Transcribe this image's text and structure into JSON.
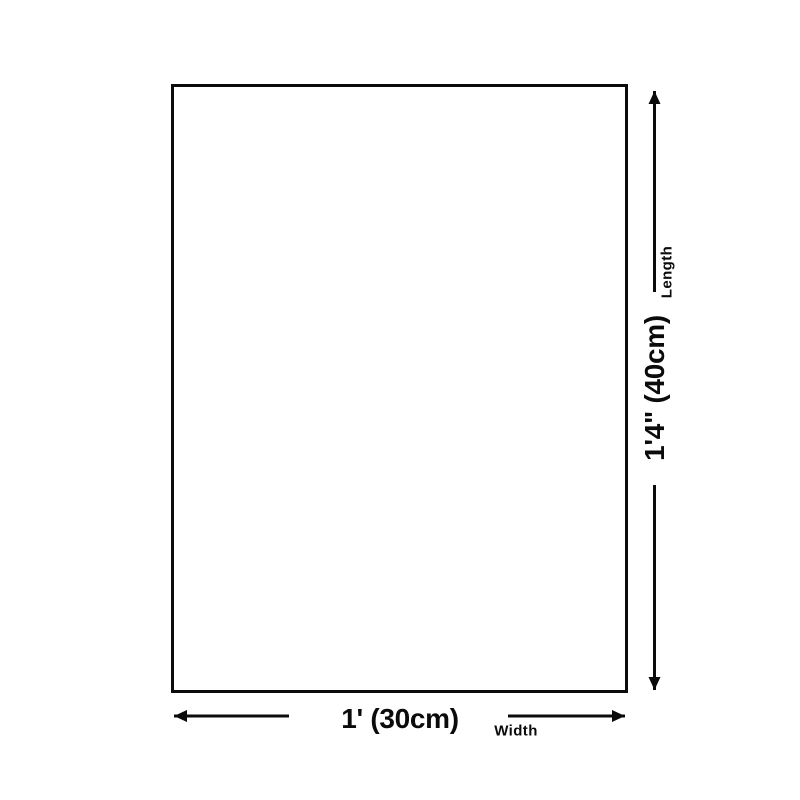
{
  "page": {
    "background_color": "#ffffff"
  },
  "diagram": {
    "line_color": "#0b0b0b",
    "length_value": "1'4\" (40cm)",
    "length_label": "Length",
    "width_value": "1' (30cm)",
    "width_label": "Width"
  }
}
